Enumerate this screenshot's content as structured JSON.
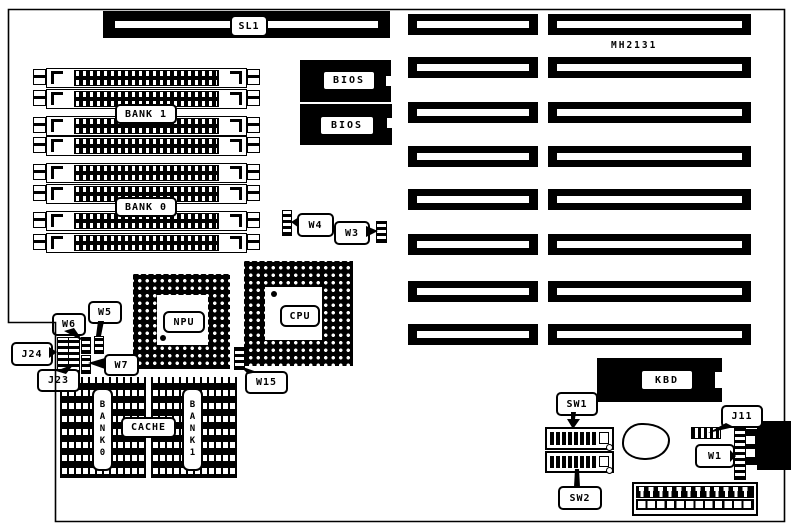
{
  "board": {
    "model_text": "MH2131",
    "sl1": "SL1",
    "bank1": "BANK 1",
    "bank0": "BANK 0",
    "bios": "BIOS",
    "npu": "NPU",
    "cpu": "CPU",
    "w1": "W1",
    "w3": "W3",
    "w4": "W4",
    "w5": "W5",
    "w6": "W6",
    "w7": "W7",
    "w15": "W15",
    "j11": "J11",
    "j23": "J23",
    "j24": "J24",
    "cache": "CACHE",
    "cache_bank0": "BANK0",
    "cache_bank1": "BANK1",
    "kbd": "KBD",
    "sw1": "SW1",
    "sw2": "SW2"
  }
}
